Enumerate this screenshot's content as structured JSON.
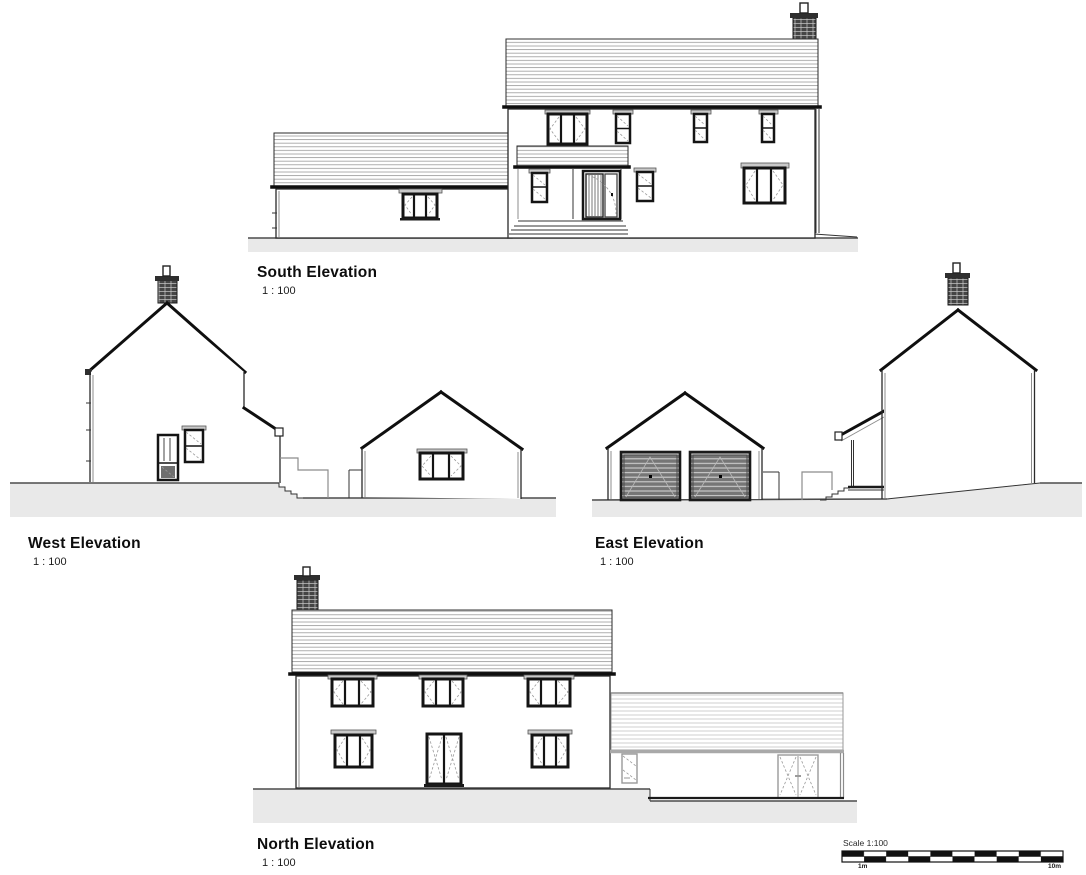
{
  "document": {
    "type": "architectural elevation sheet",
    "background": "#ffffff"
  },
  "drawings": [
    {
      "id": "south",
      "title": "South Elevation",
      "scale_label": "1 : 100"
    },
    {
      "id": "west",
      "title": "West Elevation",
      "scale_label": "1 : 100"
    },
    {
      "id": "east",
      "title": "East Elevation",
      "scale_label": "1 : 100"
    },
    {
      "id": "north",
      "title": "North Elevation",
      "scale_label": "1 : 100"
    }
  ],
  "scale_bar": {
    "title": "Scale 1:100",
    "left_label": "1m",
    "right_label": "10m",
    "divisions": 10
  },
  "colors": {
    "line": "#1a1a1a",
    "roof_hatch": "#9a9a9a",
    "roof_hatch_light": "#c4c4c4",
    "ground_fill": "#e9e9e9",
    "garage_door_fill": "#767676",
    "brick_fill": "#454545"
  }
}
